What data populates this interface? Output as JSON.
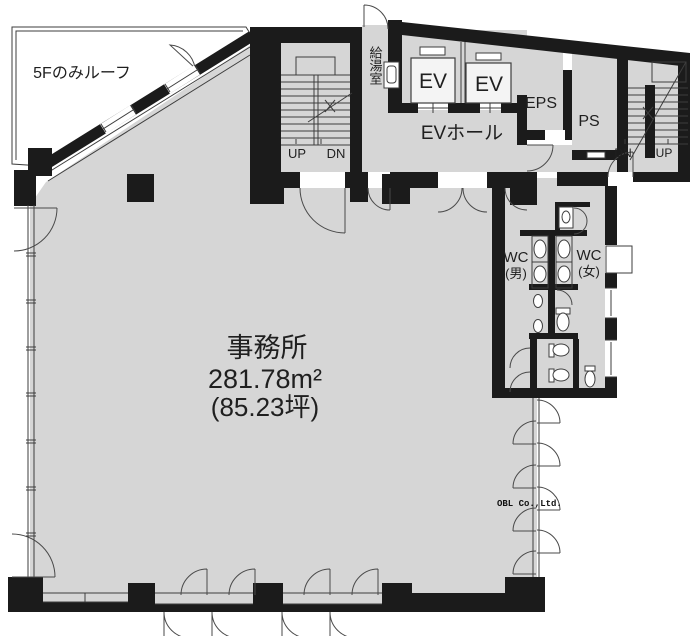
{
  "floorplan": {
    "title": "事務所フロア平面図",
    "roof_label": "5Fのみルーフ",
    "office": {
      "name": "事務所",
      "area_m2": "281.78m²",
      "area_tsubo": "(85.23坪)"
    },
    "kitchenette_label": "給湯室",
    "elevators": {
      "ev1": "EV",
      "ev2": "EV",
      "hall": "EVホール"
    },
    "shafts": {
      "eps": "EPS",
      "ps": "PS"
    },
    "stair_left": {
      "up": "UP",
      "down": "DN"
    },
    "stair_right": {
      "down": "DN",
      "up": "UP"
    },
    "toilets": {
      "men_line1": "WC",
      "men_line2": "(男)",
      "women_line1": "WC",
      "women_line2": "(女)"
    },
    "watermark": "OBL Co.,Ltd.",
    "colors": {
      "wall": "#1b1b1b",
      "floor": "#d6d6d6",
      "line": "#3d3d3d"
    }
  }
}
